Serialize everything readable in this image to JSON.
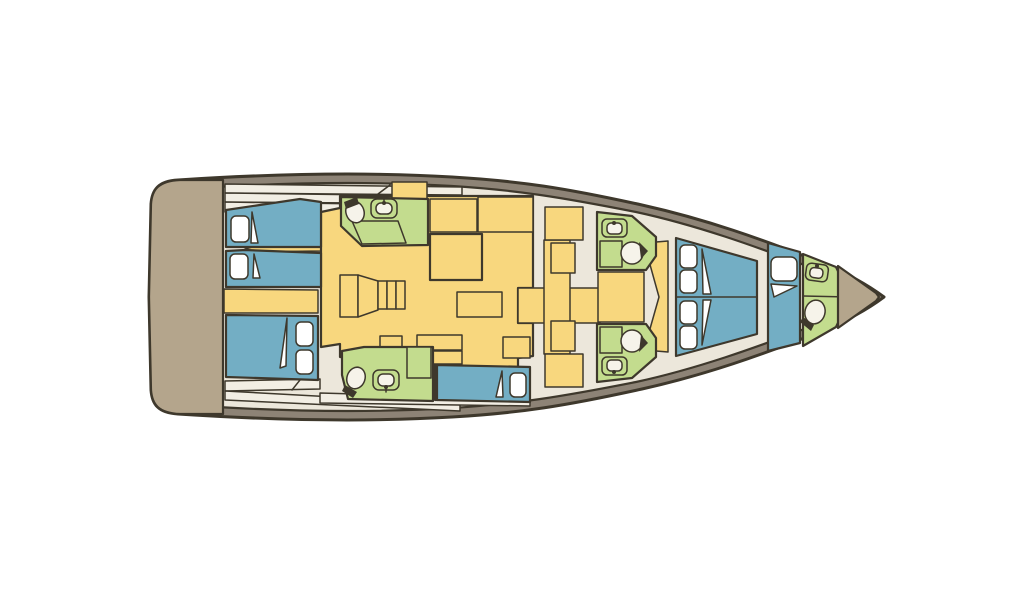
{
  "colors": {
    "background": "#ffffff",
    "outline": "#3e382c",
    "hull_band": "#8d8376",
    "interior": "#ece7db",
    "deck_strip": "#f2eee4",
    "platform_tan": "#b4a58c",
    "floor_yellow": "#f8d77e",
    "bed_blue": "#73aec4",
    "bath_green": "#c3dc8e",
    "linen_white": "#ffffff",
    "fixture_cream": "#f6f3ea"
  }
}
